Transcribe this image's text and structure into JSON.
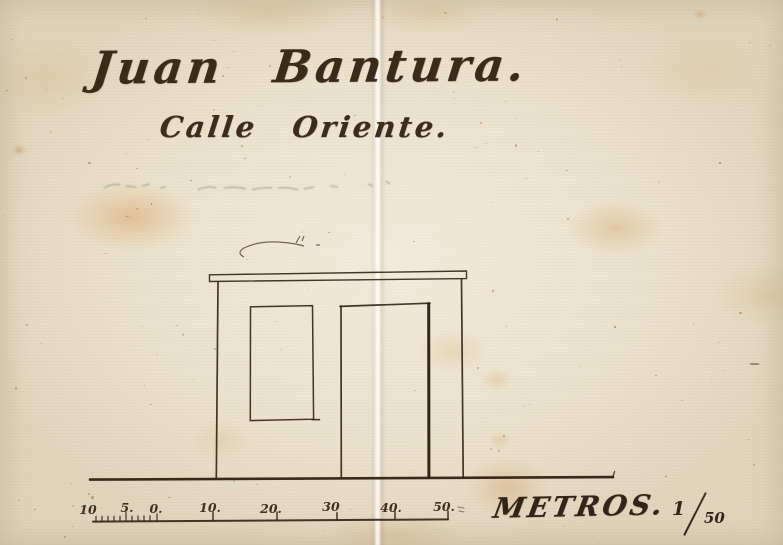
{
  "document": {
    "kind": "scanned hand-drawn building elevation",
    "title_line1": "Juan Bantura.",
    "title_line2": "Calle Oriente.",
    "scale_word": "METROS.",
    "scale_ratio": "1/50",
    "scale_ratio_numerator": "1",
    "scale_ratio_denominator": "50",
    "scale_bar_labels": [
      "10",
      "5.",
      "0.",
      "10.",
      "20.",
      "30",
      "40.",
      "50."
    ]
  },
  "colors": {
    "paper": "#ebe2cd",
    "ink": "#3a2a18",
    "stain": "#dba668"
  }
}
